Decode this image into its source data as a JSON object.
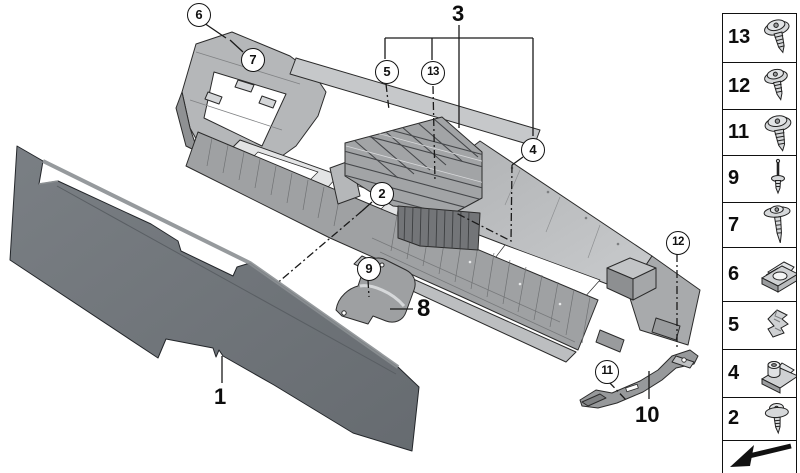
{
  "diagram": {
    "description": "Exploded parts diagram of a car centre console carrier with side trim panel and mounting brackets",
    "callouts": {
      "c1": {
        "label": "1"
      },
      "c2": {
        "label": "2"
      },
      "c3": {
        "label": "3"
      },
      "c4": {
        "label": "4"
      },
      "c5": {
        "label": "5"
      },
      "c6": {
        "label": "6"
      },
      "c7": {
        "label": "7"
      },
      "c8": {
        "label": "8"
      },
      "c9": {
        "label": "9"
      },
      "c10": {
        "label": "10"
      },
      "c11": {
        "label": "11"
      },
      "c12": {
        "label": "12"
      },
      "c13": {
        "label": "13"
      }
    }
  },
  "legend": {
    "rows": [
      {
        "number": "13",
        "icon": "pan-head-screw-icon"
      },
      {
        "number": "12",
        "icon": "pan-head-screw-icon"
      },
      {
        "number": "11",
        "icon": "pan-head-screw-icon"
      },
      {
        "number": "9",
        "icon": "blind-rivet-icon"
      },
      {
        "number": "7",
        "icon": "washer-head-screw-icon"
      },
      {
        "number": "6",
        "icon": "clip-nut-icon"
      },
      {
        "number": "5",
        "icon": "spring-clip-icon"
      },
      {
        "number": "4",
        "icon": "clip-nut-collar-icon"
      },
      {
        "number": "2",
        "icon": "washer-screw-icon"
      }
    ],
    "footer_icon": "continue-arrow-icon"
  },
  "colors": {
    "background": "#ffffff",
    "outline": "#2b2b2b",
    "panel_gray": "#6f7479",
    "carrier_gray": "#a7a9ab",
    "carrier_light": "#c6c8ca",
    "legend_border": "#111111"
  }
}
